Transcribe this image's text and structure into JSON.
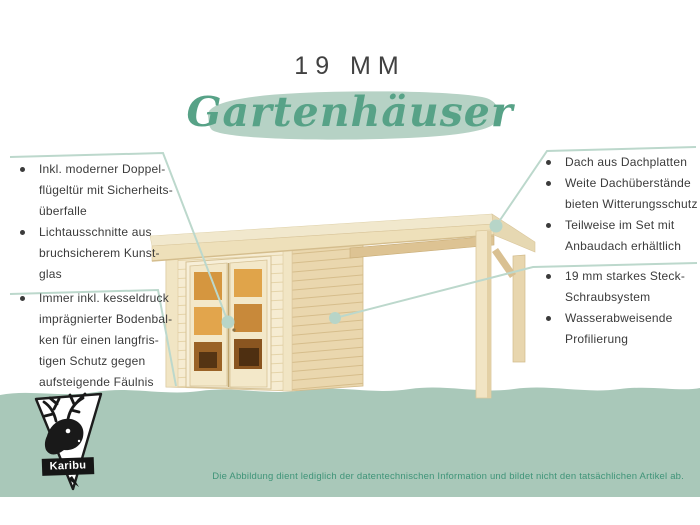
{
  "header": {
    "thickness_label": "19 MM",
    "title": "Gartenhäuser"
  },
  "callouts": {
    "left_top": {
      "bullets": [
        "Inkl. moderner Doppel-\nflügeltür mit Sicherheits-\nüberfalle",
        "Lichtausschnitte aus\nbruchsicherem Kunst-\nglas"
      ]
    },
    "left_bottom": {
      "bullets": [
        "Immer inkl. kesseldruck\nimprägnierter Bodenbal-\nken für einen langfris-\ntigen Schutz gegen\naufsteigende Fäulnis"
      ]
    },
    "right_top": {
      "bullets": [
        "Dach aus Dachplatten",
        "Weite Dachüberstände\nbieten Witterungsschutz",
        "Teilweise im Set mit\nAnbaudach erhältlich"
      ]
    },
    "right_bottom": {
      "bullets": [
        "19 mm starkes Steck-\nSchraubsystem",
        "Wasserabweisende\nProfilierung"
      ]
    }
  },
  "logo": {
    "brand": "Karibu"
  },
  "footer": {
    "disclaimer": "Die Abbildung dient lediglich der datentechnischen Information und bildet nicht den tatsächlichen Artikel ab."
  },
  "colors": {
    "band": "#a9c8b9",
    "brush_stroke": "#b6d2c5",
    "script_green": "#57a287",
    "leader_line": "#bcd8cc",
    "disclaimer_green": "#3f9478",
    "body_text": "#3b3b3b",
    "wood_front": "#f6ecd2",
    "wood_side": "#ead7ae",
    "glass_amber": "#dd9b44"
  }
}
